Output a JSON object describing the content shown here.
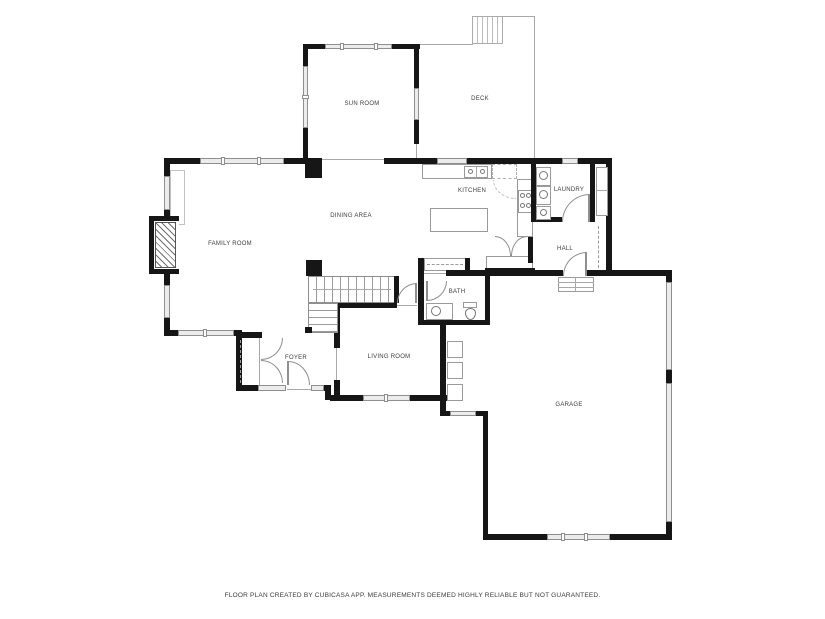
{
  "rooms": {
    "sun_room": "SUN ROOM",
    "deck": "DECK",
    "kitchen": "KITCHEN",
    "laundry": "LAUNDRY",
    "dining": "DINING AREA",
    "family": "FAMILY ROOM",
    "hall": "HALL",
    "bath": "BATH",
    "foyer": "FOYER",
    "living": "LIVING ROOM",
    "garage": "GARAGE"
  },
  "footer": {
    "text": "FLOOR PLAN CREATED BY CUBICASA APP. MEASUREMENTS DEEMED HIGHLY RELIABLE BUT NOT GUARANTEED."
  },
  "colors": {
    "wall": "#161616",
    "window_fill": "#ececec",
    "thin_line": "#9a9a9a",
    "label_text": "#3d3d3d",
    "background": "#ffffff"
  }
}
